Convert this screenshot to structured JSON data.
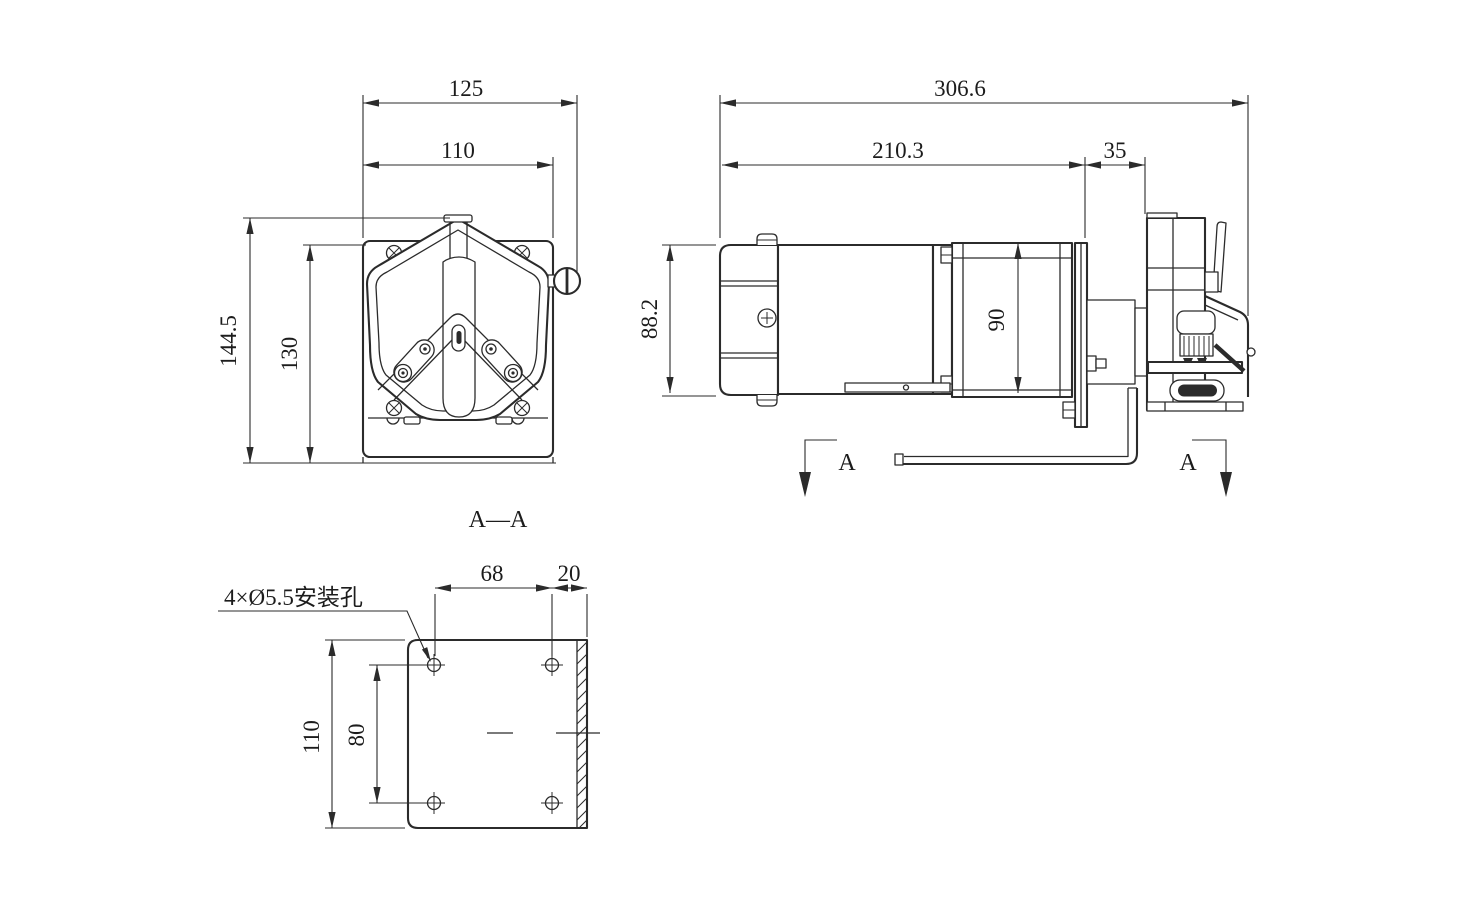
{
  "style": {
    "background": "#ffffff",
    "line_color": "#2b2b2b",
    "text_color": "#1c1c1c"
  },
  "front_view": {
    "dim_width_outer": "125",
    "dim_width_inner": "110",
    "dim_height_outer": "144.5",
    "dim_height_inner": "130",
    "section_label": "A—A"
  },
  "side_view": {
    "dim_length_overall": "306.6",
    "dim_length_motor": "210.3",
    "dim_length_gap": "35",
    "dim_height_motor": "88.2",
    "dim_height_gearbox": "90",
    "section_arrow_left": "A",
    "section_arrow_right": "A"
  },
  "bottom_view": {
    "dim_hole_spacing_x": "68",
    "dim_edge_offset": "20",
    "dim_plate_length": "110",
    "dim_hole_spacing_y": "80",
    "mounting_holes_label": "4×Ø5.5安装孔"
  }
}
